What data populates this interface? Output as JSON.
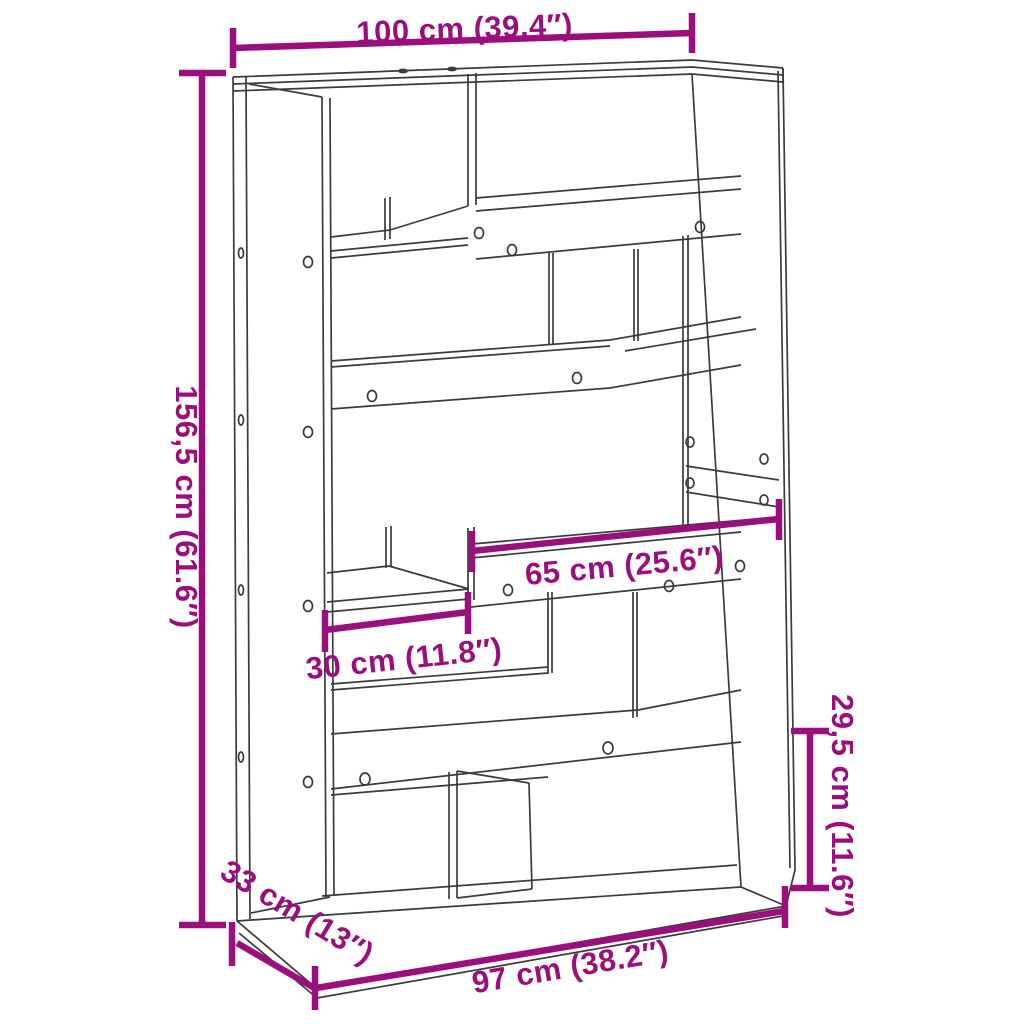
{
  "diagram": {
    "kind": "furniture-dimension-drawing",
    "subject": "bookcase-room-divider",
    "colors": {
      "dimension_accent": "#9b0f7d",
      "drawing_line": "#3b3b3b",
      "background": "#ffffff"
    },
    "dimensions": {
      "width_top": {
        "label": "100 cm (39.4″)",
        "value_cm": "100",
        "value_inch": "39.4"
      },
      "height": {
        "label": "156,5 cm (61.6″)",
        "value_cm": "156,5",
        "value_inch": "61.6"
      },
      "shelf_width": {
        "label": "65 cm (25.6″)",
        "value_cm": "65",
        "value_inch": "25.6"
      },
      "shelf_small": {
        "label": "30 cm (11.8″)",
        "value_cm": "30",
        "value_inch": "11.8"
      },
      "shelf_height": {
        "label": "29,5 cm (11.6″)",
        "value_cm": "29,5",
        "value_inch": "11.6"
      },
      "depth": {
        "label": "33 cm (13″)",
        "value_cm": "33",
        "value_inch": "13"
      },
      "width_bottom": {
        "label": "97 cm (38.2″)",
        "value_cm": "97",
        "value_inch": "38.2"
      }
    }
  }
}
